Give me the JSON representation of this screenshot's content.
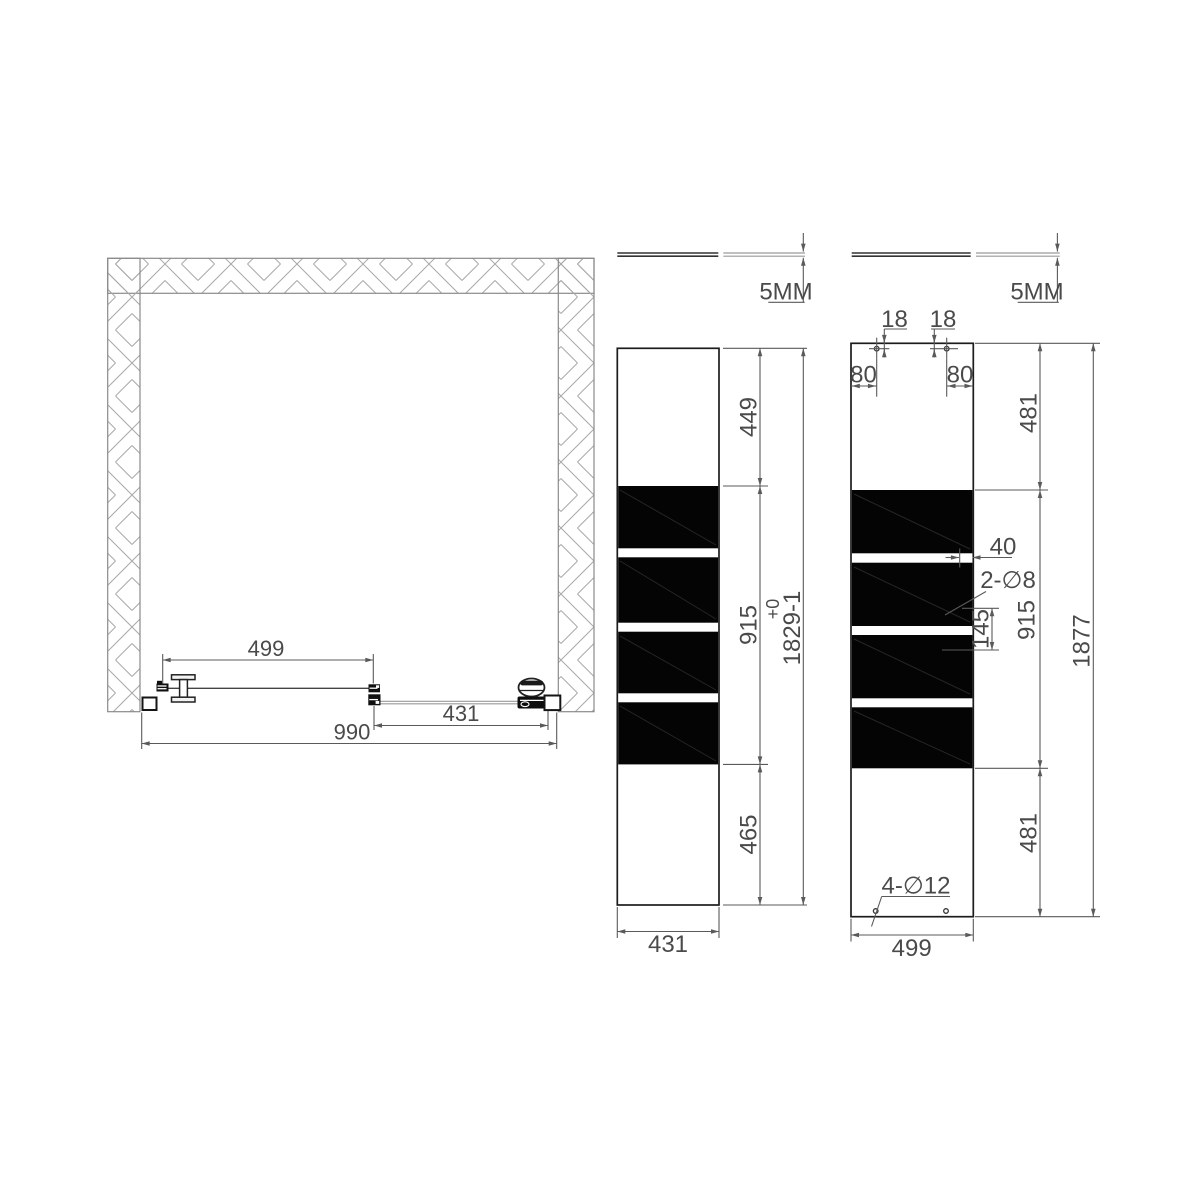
{
  "title": "shower-enclosure-technical-drawing",
  "plan_view": {
    "width_total": "990",
    "width_door_section": "499",
    "width_fixed_section": "431"
  },
  "door_elevation": {
    "glass_thickness": "5MM",
    "top_section": "449",
    "stripe_section": "915",
    "bottom_section": "465",
    "overall_height": "1829-1",
    "height_tolerance": "+0",
    "width": "431"
  },
  "fixed_panel_elevation": {
    "glass_thickness": "5MM",
    "hole_top_offset_left": "18",
    "hole_top_offset_right": "18",
    "hole_edge_offset_left": "80",
    "hole_edge_offset_right": "80",
    "top_section": "481",
    "stripe_section": "915",
    "bottom_section": "481",
    "overall_height": "1877",
    "width": "499",
    "handle_hole_edge_offset": "40",
    "handle_holes_label": "2-∅8",
    "handle_hole_spacing": "145",
    "mounting_holes_label": "4-∅12"
  }
}
